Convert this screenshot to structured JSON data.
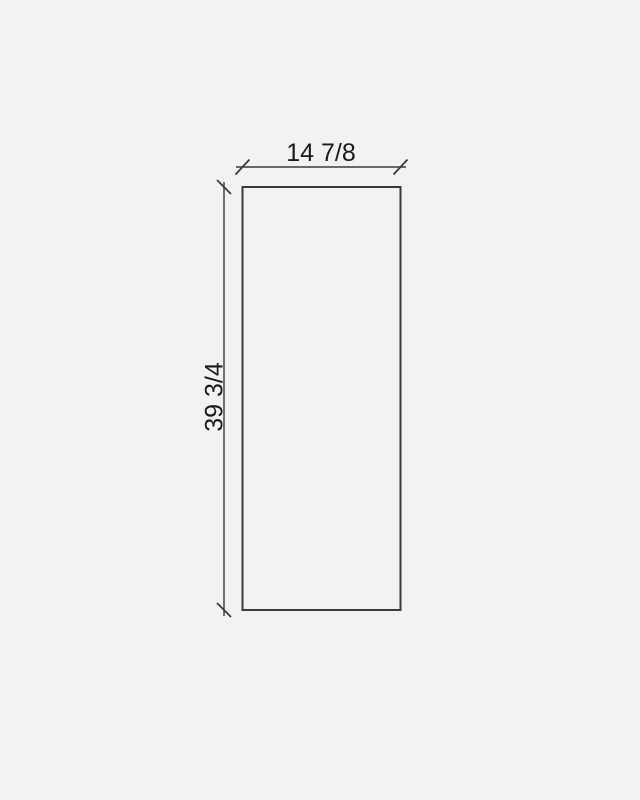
{
  "drawing": {
    "width_label": "14 7/8",
    "height_label": "39 3/4",
    "colors": {
      "background": "#f2f2f2",
      "stroke": "#3a3a3a",
      "text": "#1a1a1a"
    }
  }
}
